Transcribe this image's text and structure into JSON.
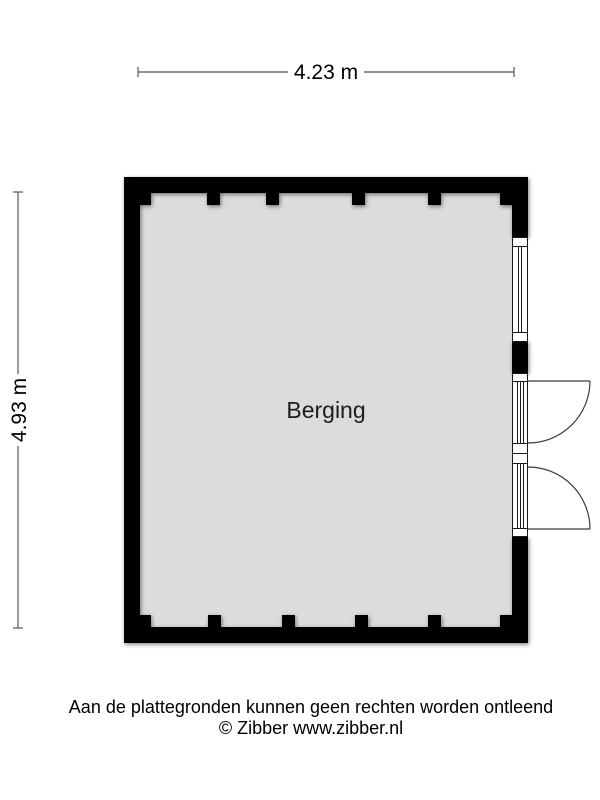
{
  "floorplan": {
    "room_label": "Berging",
    "width_label": "4.23 m",
    "height_label": "4.93 m",
    "colors": {
      "wall": "#000000",
      "floor": "#dcdcdc",
      "dimension_line": "#6e6e6e",
      "frame_line": "#1a1a1a",
      "door_swing": "#3c3c3c"
    }
  },
  "footer": {
    "disclaimer": "Aan de plattegronden kunnen geen rechten worden ontleend",
    "credit": "© Zibber www.zibber.nl"
  }
}
